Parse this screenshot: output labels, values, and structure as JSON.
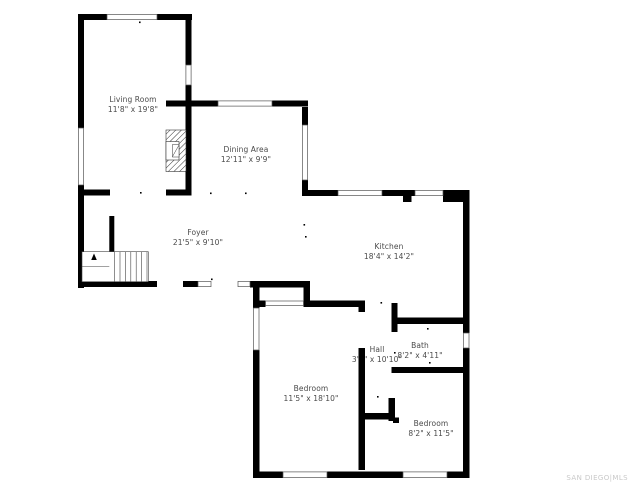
{
  "plan": {
    "type": "residential-floor-plan",
    "floor_visible_rooms": 8
  },
  "rooms": {
    "living_room": {
      "name": "Living Room",
      "dims": "11'8\" x 19'8\""
    },
    "dining_area": {
      "name": "Dining Area",
      "dims": "12'11\" x 9'9\""
    },
    "foyer": {
      "name": "Foyer",
      "dims": "21'5\" x 9'10\""
    },
    "kitchen": {
      "name": "Kitchen",
      "dims": "18'4\" x 14'2\""
    },
    "hall": {
      "name": "Hall",
      "dims": "3'1\" x 10'10\""
    },
    "bath": {
      "name": "Bath",
      "dims": "8'2\" x 4'11\""
    },
    "bedroom_left": {
      "name": "Bedroom",
      "dims": "11'5\" x 18'10\""
    },
    "bedroom_right": {
      "name": "Bedroom",
      "dims": "8'2\" x 11'5\""
    }
  },
  "watermark": {
    "text": "SAN DIEGO|MLS",
    "color": "#c9c9c9"
  },
  "colors": {
    "wall": "#000000",
    "background": "#ffffff",
    "label_text": "#4a4a4a",
    "window_outline": "#555555",
    "stair_lines": "#444444"
  }
}
